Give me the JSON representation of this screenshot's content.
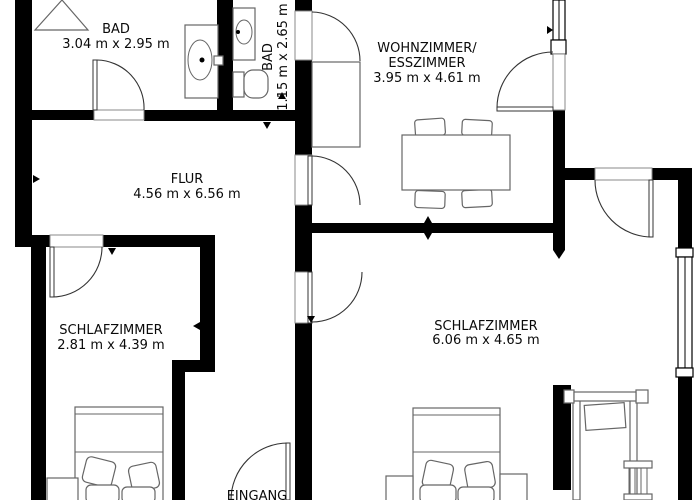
{
  "rooms": {
    "bad_large": {
      "name": "BAD",
      "dims": "3.04 m x 2.95 m"
    },
    "bad_small": {
      "name": "BAD",
      "dims": "1.15 m x 2.65 m"
    },
    "wohnzimmer": {
      "name_line1": "WOHNZIMMER/",
      "name_line2": "ESSZIMMER",
      "dims": "3.95 m x 4.61 m"
    },
    "flur": {
      "name": "FLUR",
      "dims": "4.56 m x 6.56 m"
    },
    "schlafzimmer_left": {
      "name": "SCHLAFZIMMER",
      "dims": "2.81 m x 4.39 m"
    },
    "schlafzimmer_right": {
      "name": "SCHLAFZIMMER",
      "dims": "6.06 m x 4.65 m"
    },
    "eingang": {
      "name": "EINGANG"
    }
  },
  "symbols": [
    "corner-shower",
    "washbasin",
    "toilet",
    "interior-door",
    "window",
    "wardrobe",
    "dining-table",
    "chair",
    "double-bed",
    "pillow",
    "blanket",
    "nightstand",
    "clothes-rack",
    "ladder"
  ],
  "colors": {
    "wall": "#000000",
    "line": "#333333",
    "furniture": "#666666",
    "background": "#ffffff",
    "text": "#0a0a0a"
  }
}
